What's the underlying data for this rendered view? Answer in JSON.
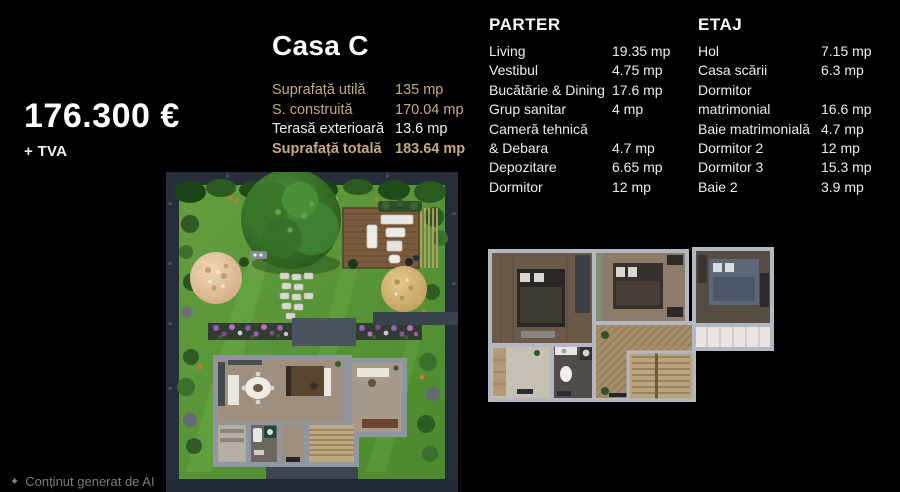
{
  "price": {
    "amount": "176.300 €",
    "vat": "+ TVA"
  },
  "property": {
    "title": "Casa C",
    "areas": [
      {
        "label": "Suprafață utilă",
        "value": "135 mp",
        "highlight": true,
        "bold": false
      },
      {
        "label": "S. construită",
        "value": "170.04 mp",
        "highlight": true,
        "bold": false
      },
      {
        "label": "Terasă exterioară",
        "value": "13.6 mp",
        "highlight": false,
        "bold": false
      },
      {
        "label": "Suprafață totală",
        "value": "183.64 mp",
        "highlight": true,
        "bold": true
      }
    ]
  },
  "floors": [
    {
      "name": "PARTER",
      "rooms": [
        {
          "label": "Living",
          "value": "19.35 mp"
        },
        {
          "label": "Vestibul",
          "value": "4.75 mp"
        },
        {
          "label": "Bucătărie & Dining",
          "value": "17.6 mp"
        },
        {
          "label": "Grup sanitar",
          "value": "4 mp"
        },
        {
          "label": "Cameră tehnică",
          "value": ""
        },
        {
          "label": "& Debara",
          "value": "4.7 mp"
        },
        {
          "label": "Depozitare",
          "value": "6.65 mp"
        },
        {
          "label": "Dormitor",
          "value": "12 mp"
        }
      ]
    },
    {
      "name": "ETAJ",
      "rooms": [
        {
          "label": "Hol",
          "value": "7.15 mp"
        },
        {
          "label": "Casa scării",
          "value": "6.3 mp"
        },
        {
          "label": "Dormitor",
          "value": ""
        },
        {
          "label": "matrimonial",
          "value": "16.6 mp"
        },
        {
          "label": "Baie matrimonială",
          "value": "4.7 mp"
        },
        {
          "label": "Dormitor 2",
          "value": "12 mp"
        },
        {
          "label": "Dormitor 3",
          "value": "15.3 mp"
        },
        {
          "label": "Baie 2",
          "value": "3.9 mp"
        }
      ]
    }
  ],
  "images": {
    "site_plan": "garden-site-plan-top-view",
    "upper_floor": "etaj-floor-plan-3d"
  },
  "footer": {
    "note": "Conținut generat de AI"
  },
  "colors": {
    "background": "#000000",
    "gold": "#c7ab79",
    "text": "#f2f2f2",
    "muted": "#7d7d7d"
  }
}
